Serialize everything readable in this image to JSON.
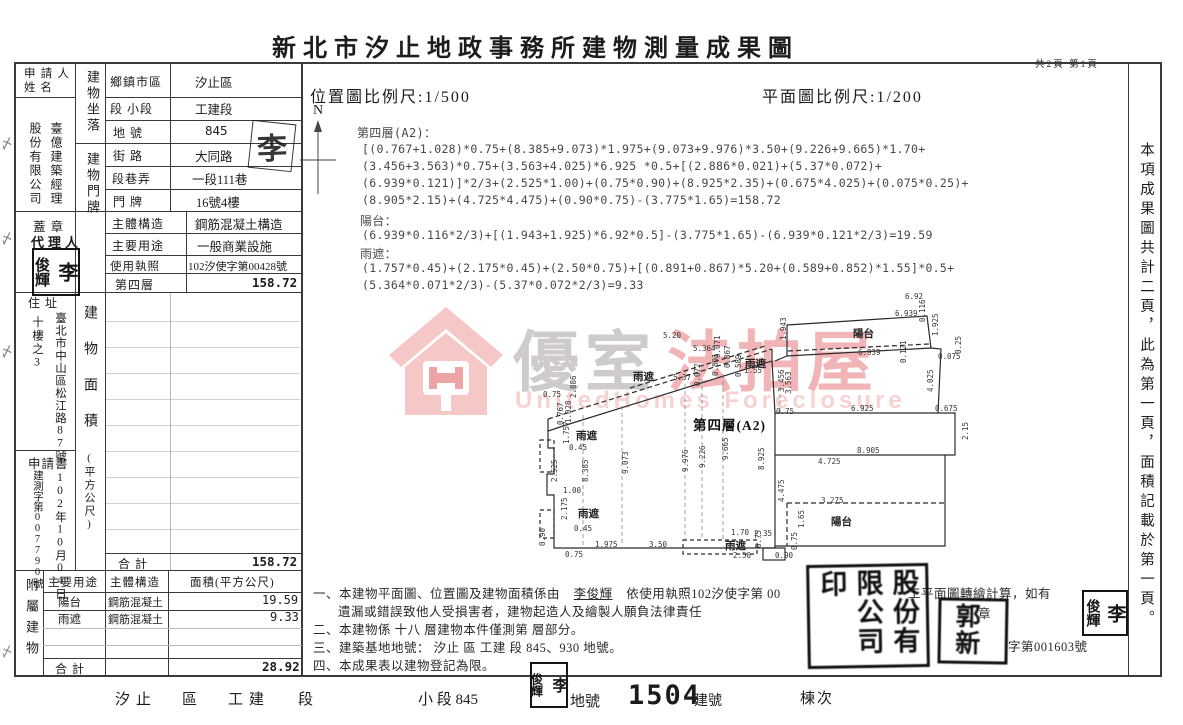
{
  "title": "新北市汐止地政事務所建物測量成果圖",
  "page_info": "共2頁 第1頁",
  "scales": {
    "location": "位置圖比例尺:1/500",
    "plan": "平面圖比例尺:1/200",
    "north": "N"
  },
  "side_note": "本項成果圖共計二頁，此為第一頁，面積記載於第一頁。",
  "left_panel": {
    "applicant_label": "申請人姓 名",
    "applicant_name_right": "臺億建築經理",
    "applicant_name_left": "股份有限公司",
    "location_label": "建物坐落",
    "rows_location": [
      {
        "label": "鄉鎮市區",
        "value": "汐止區"
      },
      {
        "label": "段 小段",
        "value": "工建段"
      },
      {
        "label": "地 號",
        "value": "845"
      }
    ],
    "door_label": "建物門牌",
    "rows_door": [
      {
        "label": "街 路",
        "value": "大同路"
      },
      {
        "label": "段巷弄",
        "value": "一段111巷"
      },
      {
        "label": "門 牌",
        "value": "16號4樓"
      }
    ],
    "seal_label": "蓋 章",
    "agent_label": "代理人",
    "rows_info": [
      {
        "label": "主體構造",
        "value": "鋼筋混凝土構造"
      },
      {
        "label": "主要用途",
        "value": "一般商業設施"
      },
      {
        "label": "使用執照",
        "value": "102汐使字第00428號"
      },
      {
        "label": "第四層",
        "value": "158.72"
      }
    ],
    "address_label": "住 址",
    "address_right": "臺北市中山區松江路87號",
    "address_left": "十樓之3",
    "area_label": "建物面積",
    "area_unit": "(平方公尺)",
    "application_label": "申請書",
    "application_no": "建測字第007790號",
    "application_date": "102年10月04日",
    "total_label": "合  計",
    "total_value": "158.72"
  },
  "attached": {
    "side_label": "附屬建物",
    "headers": [
      "主要用途",
      "主體構造",
      "面積(平方公尺)"
    ],
    "rows": [
      {
        "use": "陽台",
        "structure": "鋼筋混凝土",
        "area": "19.59"
      },
      {
        "use": "雨遮",
        "structure": "鋼筋混凝土",
        "area": "9.33"
      }
    ],
    "total_label": "合 計",
    "total_value": "28.92"
  },
  "formulas": {
    "floor_label": "第四層(A2)：",
    "floor_lines": [
      "[(0.767+1.028)*0.75+(8.385+9.073)*1.975+(9.073+9.976)*3.50+(9.226+9.665)*1.70+",
      "(3.456+3.563)*0.75+(3.563+4.025)*6.925 *0.5+[(2.886*0.021)+(5.37*0.072)+",
      "(6.939*0.121)]*2/3+(2.525*1.00)+(0.75*0.90)+(8.925*2.35)+(0.675*4.025)+(0.075*0.25)+",
      "(8.905*2.15)+(4.725*4.475)+(0.90*0.75)-(3.775*1.65)=158.72"
    ],
    "balcony_label": "陽台：",
    "balcony_lines": [
      "(6.939*0.116*2/3)+[(1.943+1.925)*6.92*0.5]-(3.775*1.65)-(6.939*0.121*2/3)=19.59"
    ],
    "canopy_label": "雨遮：",
    "canopy_lines": [
      "(1.757*0.45)+(2.175*0.45)+(2.50*0.75)+[(0.891+0.867)*5.20+(0.589+0.852)*1.55]*0.5+",
      "(5.364*0.071*2/3)-(5.37*0.072*2/3)=9.33"
    ]
  },
  "watermark": {
    "cn_gray": "優室",
    "cn_red": "法拍屋",
    "en": "UnitedHomes Foreclosure"
  },
  "plan": {
    "labels": [
      {
        "t": "6.92",
        "x": 370,
        "y": 4,
        "k": "n"
      },
      {
        "t": "6.939",
        "x": 360,
        "y": 21,
        "k": "n"
      },
      {
        "t": "0.116",
        "x": 383,
        "y": 34,
        "k": "n",
        "r": 1
      },
      {
        "t": "陽台",
        "x": 318,
        "y": 38,
        "k": "c"
      },
      {
        "t": "1.943",
        "x": 244,
        "y": 52,
        "k": "n",
        "r": 1
      },
      {
        "t": "1.925",
        "x": 396,
        "y": 48,
        "k": "n",
        "r": 1
      },
      {
        "t": "6.939",
        "x": 323,
        "y": 60,
        "k": "n"
      },
      {
        "t": "0.121",
        "x": 364,
        "y": 75,
        "k": "n",
        "r": 1
      },
      {
        "t": "0.075",
        "x": 403,
        "y": 64,
        "k": "n"
      },
      {
        "t": "0.25",
        "x": 419,
        "y": 66,
        "k": "n",
        "r": 1
      },
      {
        "t": "4.025",
        "x": 391,
        "y": 104,
        "k": "n",
        "r": 1
      },
      {
        "t": "0.75",
        "x": 241,
        "y": 119,
        "k": "n"
      },
      {
        "t": "6.925",
        "x": 316,
        "y": 116,
        "k": "n"
      },
      {
        "t": "0.675",
        "x": 400,
        "y": 116,
        "k": "n"
      },
      {
        "t": "2.15",
        "x": 426,
        "y": 152,
        "k": "n",
        "r": 1
      },
      {
        "t": "8.905",
        "x": 322,
        "y": 158,
        "k": "n"
      },
      {
        "t": "4.725",
        "x": 283,
        "y": 169,
        "k": "n"
      },
      {
        "t": "8.925",
        "x": 222,
        "y": 182,
        "k": "n",
        "r": 1
      },
      {
        "t": "9.976",
        "x": 146,
        "y": 184,
        "k": "n",
        "r": 1
      },
      {
        "t": "9.226",
        "x": 163,
        "y": 180,
        "k": "n",
        "r": 1
      },
      {
        "t": "9.665",
        "x": 186,
        "y": 172,
        "k": "n",
        "r": 1
      },
      {
        "t": "4.475",
        "x": 242,
        "y": 214,
        "k": "n",
        "r": 1
      },
      {
        "t": "3.275",
        "x": 286,
        "y": 208,
        "k": "n"
      },
      {
        "t": "1.65",
        "x": 262,
        "y": 240,
        "k": "n",
        "r": 1
      },
      {
        "t": "陽台",
        "x": 296,
        "y": 226,
        "k": "c"
      },
      {
        "t": "0.75",
        "x": 255,
        "y": 262,
        "k": "n",
        "r": 1
      },
      {
        "t": "0.90",
        "x": 240,
        "y": 263,
        "k": "n"
      },
      {
        "t": "1.70",
        "x": 196,
        "y": 240,
        "k": "n"
      },
      {
        "t": "2.35",
        "x": 219,
        "y": 241,
        "k": "n"
      },
      {
        "t": "雨遮",
        "x": 190,
        "y": 250,
        "k": "c"
      },
      {
        "t": "0.75",
        "x": 219,
        "y": 260,
        "k": "n",
        "r": 1
      },
      {
        "t": "2.50",
        "x": 198,
        "y": 263,
        "k": "n"
      },
      {
        "t": "第四層(A2)",
        "x": 158,
        "y": 126,
        "k": "tt"
      },
      {
        "t": "1.757",
        "x": 27,
        "y": 156,
        "k": "n",
        "r": 1
      },
      {
        "t": "雨遮",
        "x": 41,
        "y": 140,
        "k": "c"
      },
      {
        "t": "0.45",
        "x": 34,
        "y": 155,
        "k": "n"
      },
      {
        "t": "2.525",
        "x": 15,
        "y": 194,
        "k": "n",
        "r": 1
      },
      {
        "t": "8.385",
        "x": 46,
        "y": 194,
        "k": "n",
        "r": 1
      },
      {
        "t": "9.073",
        "x": 86,
        "y": 186,
        "k": "n",
        "r": 1
      },
      {
        "t": "1.00",
        "x": 28,
        "y": 198,
        "k": "n"
      },
      {
        "t": "2.175",
        "x": 25,
        "y": 232,
        "k": "n",
        "r": 1
      },
      {
        "t": "雨遮",
        "x": 43,
        "y": 218,
        "k": "c"
      },
      {
        "t": "0.45",
        "x": 39,
        "y": 236,
        "k": "n"
      },
      {
        "t": "0.90",
        "x": 3,
        "y": 258,
        "k": "n",
        "r": 1
      },
      {
        "t": "1.975",
        "x": 60,
        "y": 252,
        "k": "n"
      },
      {
        "t": "3.50",
        "x": 114,
        "y": 252,
        "k": "n"
      },
      {
        "t": "0.75",
        "x": 30,
        "y": 262,
        "k": "n"
      },
      {
        "t": "5.20",
        "x": 128,
        "y": 43,
        "k": "n"
      },
      {
        "t": "5.364",
        "x": 158,
        "y": 56,
        "k": "n"
      },
      {
        "t": "0.071",
        "x": 178,
        "y": 70,
        "k": "n",
        "r": 1
      },
      {
        "t": "雨遮",
        "x": 98,
        "y": 81,
        "k": "c"
      },
      {
        "t": "5.37",
        "x": 138,
        "y": 85,
        "k": "n"
      },
      {
        "t": "0.072",
        "x": 158,
        "y": 98,
        "k": "n",
        "r": 1
      },
      {
        "t": "0.867",
        "x": 188,
        "y": 80,
        "k": "n",
        "r": 1
      },
      {
        "t": "0.891",
        "x": 176,
        "y": 88,
        "k": "n",
        "r": 1
      },
      {
        "t": "雨遮",
        "x": 210,
        "y": 68,
        "k": "c"
      },
      {
        "t": "0.589",
        "x": 199,
        "y": 89,
        "k": "n",
        "r": 1
      },
      {
        "t": "1.55",
        "x": 209,
        "y": 78,
        "k": "n"
      },
      {
        "t": "3.456",
        "x": 242,
        "y": 104,
        "k": "n",
        "r": 1
      },
      {
        "t": "3.563",
        "x": 249,
        "y": 106,
        "k": "n",
        "r": 1
      },
      {
        "t": "0.75",
        "x": 8,
        "y": 102,
        "k": "n"
      },
      {
        "t": "2.886",
        "x": 34,
        "y": 110,
        "k": "n",
        "r": 1
      },
      {
        "t": "0.767",
        "x": 21,
        "y": 137,
        "k": "n",
        "r": 1
      },
      {
        "t": "1.028",
        "x": 29,
        "y": 135,
        "k": "n",
        "r": 1
      }
    ]
  },
  "notes": {
    "line1_prefix": "一、本建物平面圖、位置圖及建物面積係由",
    "line1_name": "李俊輝",
    "line1_suffix": "依使用執照102汐使字第  00",
    "line2": "遺漏或錯誤致他人受損害者，建物起造人及繪製人願負法律責任",
    "line3": "二、本建物係  十八  層建物本件僅測第        層部分。",
    "line4": "三、建築基地地號：  汐止  區  工建  段        845、930      地號。",
    "line5": "四、本成果表以建物登記為限。",
    "frag_right_1": "工平面圖轉繪計算，如有",
    "frag_right_2": "章",
    "frag_right_3": "字第001603號"
  },
  "footer": {
    "district": "汐止",
    "district_word": "區",
    "section": "工建",
    "section_word": "段",
    "subsection": "小 段 845",
    "parcel_word": "地號",
    "building_no": "1504",
    "building_word": "建號",
    "order_word": "棟次"
  },
  "seals": {
    "agent_left": "俊輝",
    "agent_right": "李",
    "signature": "李",
    "big": "臺億建築經理股份有限公司印",
    "medium": "郭新",
    "small_left": "俊輝",
    "small_right": "李",
    "footer_left": "俊輝",
    "footer_right": "李"
  }
}
